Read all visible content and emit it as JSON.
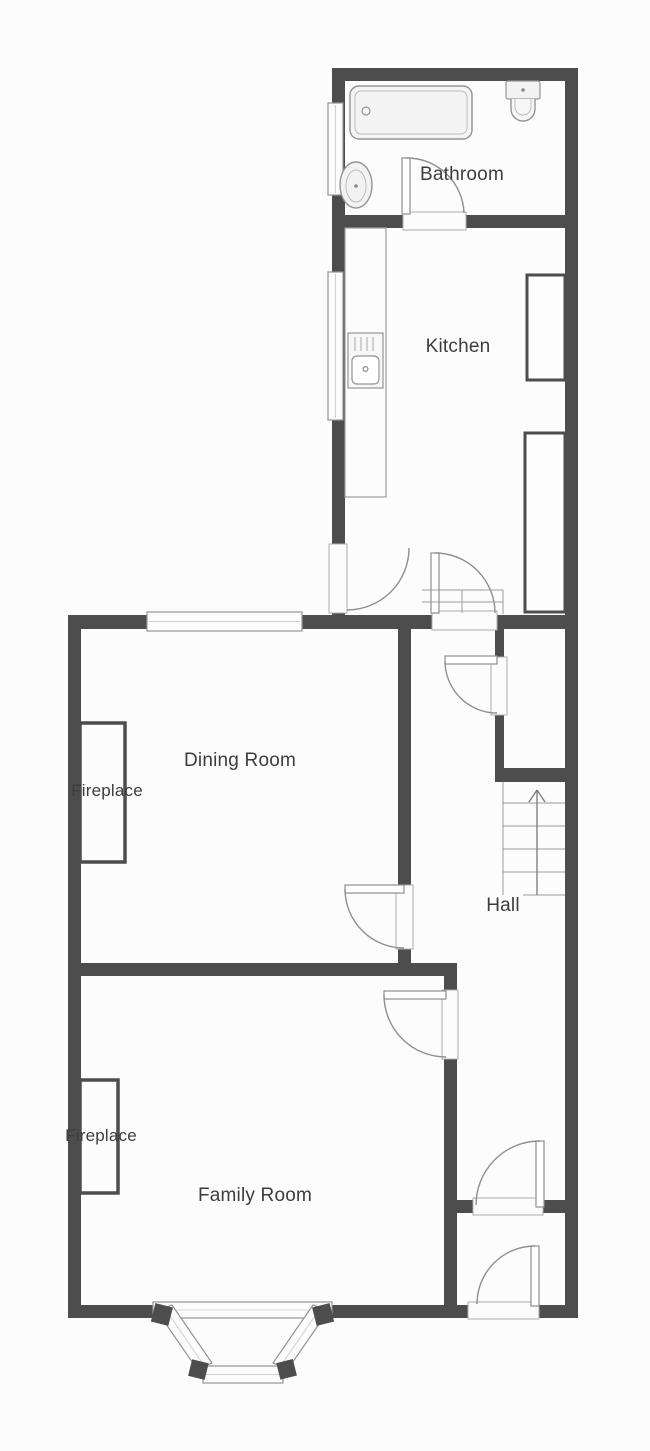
{
  "floorplan": {
    "rooms": {
      "bathroom": "Bathroom",
      "kitchen": "Kitchen",
      "dining_room": "Dining Room",
      "hall": "Hall",
      "family_room": "Family Room"
    },
    "features": {
      "dining_fireplace": "Fireplace",
      "family_fireplace": "Fireplace",
      "stairs_direction": "up"
    },
    "colors": {
      "wall": "#4d4d4d",
      "label_text": "#3d3d3d",
      "fixture_stroke": "#949494",
      "floor": "#fcfcfc"
    }
  }
}
